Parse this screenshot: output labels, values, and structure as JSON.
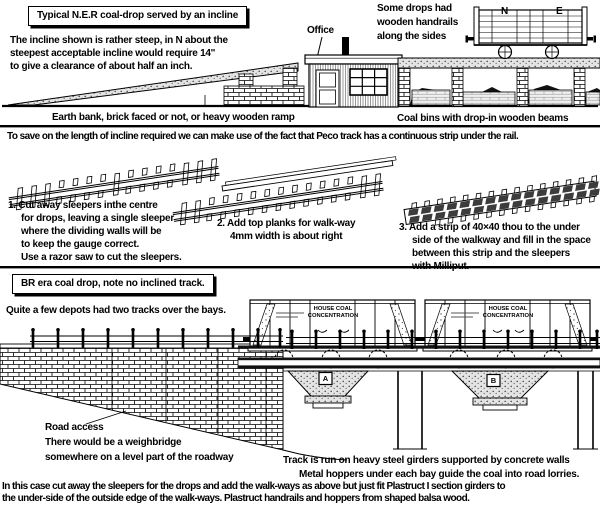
{
  "colors": {
    "ink": "#000000",
    "paper": "#ffffff"
  },
  "top": {
    "title": "Typical N.E.R coal-drop served by an incline",
    "intro": [
      "The incline shown is rather steep, in N about the",
      "steepest acceptable incline would require 14''",
      "to give a clearance of about half an inch."
    ],
    "handrail_note": [
      "Some drops had",
      "wooden handrails",
      "along the sides"
    ],
    "office_label": "Office",
    "wagon_letter_n": "N",
    "wagon_letter_e": "E",
    "ramp_caption": "Earth bank, brick faced or not, or heavy wooden ramp",
    "bins_caption": "Coal bins with drop-in wooden beams"
  },
  "middle": {
    "peco_note": "To save on the length of incline required we can make use of the fact that Peco track has a continuous strip under the rail.",
    "step1": [
      "1. Cut away sleepers inthe centre",
      "for drops, leaving a single sleeper",
      "where the dividing walls will be",
      "to keep the gauge correct.",
      "Use a razor saw to cut the sleepers."
    ],
    "step2": [
      "2. Add top planks for walk-way",
      "4mm width is about right"
    ],
    "step3": [
      "3. Add a strip of 40×40 thou to the under",
      "side of the walkway and fill in the space",
      "between this strip and the sleepers",
      "with Milliput."
    ]
  },
  "br": {
    "title": "BR era coal drop, note no inclined track.",
    "depots_note": "Quite a few depots had two tracks over the bays.",
    "wagon_text": [
      "HOUSE COAL",
      "CONCENTRATION"
    ],
    "bay_a": "A",
    "bay_b": "B",
    "road_note": [
      "Road access",
      "There would be a weighbridge",
      "somewhere on a level part of the roadway"
    ],
    "girder_caption": "Track is run on heavy steel girders supported by concrete walls",
    "hopper_caption": "Metal hoppers under each bay guide the coal into road lorries."
  },
  "footer": [
    "In this case cut away the sleepers for the drops and add the walk-ways as above but just fit Plastruct I section girders to",
    "the under-side of the outside edge of the walk-ways.  Plastruct handrails and hoppers from shaped balsa wood."
  ]
}
